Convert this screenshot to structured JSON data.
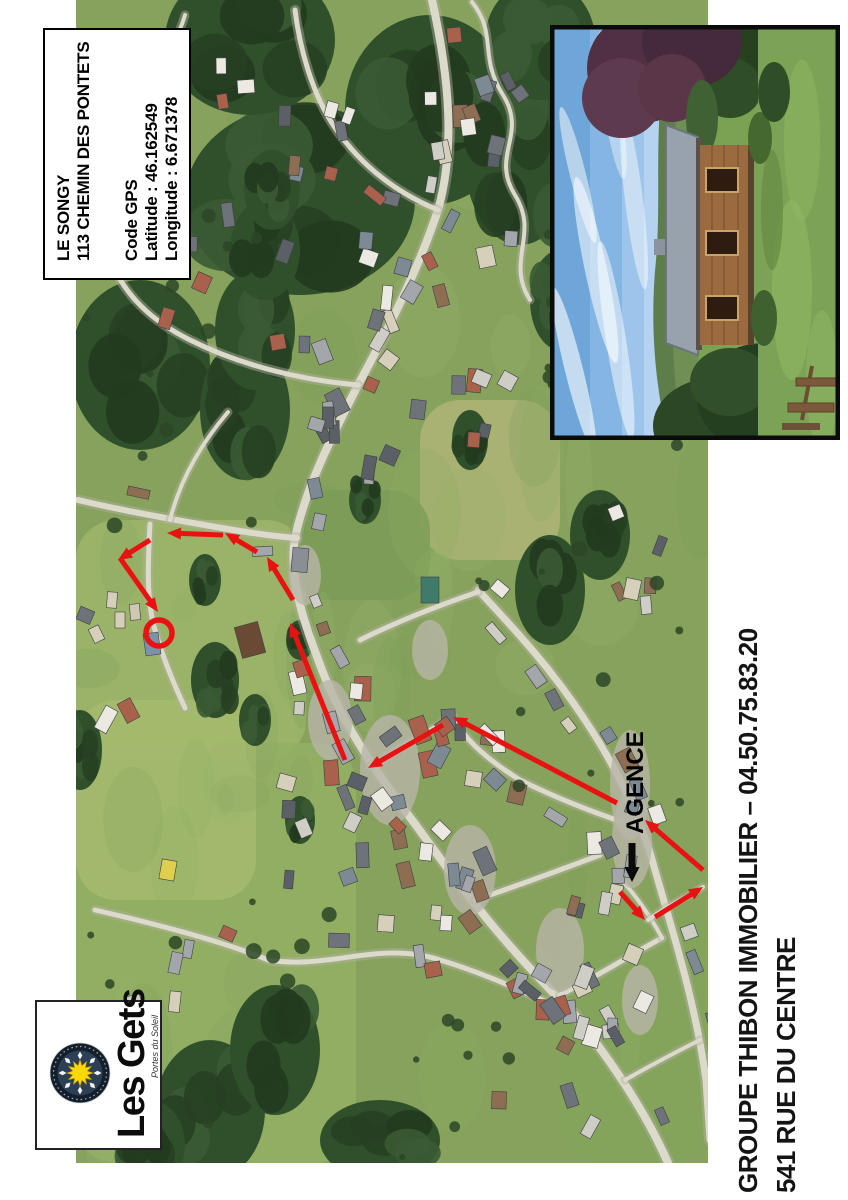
{
  "info_box": {
    "line1": "LE SONGY",
    "line2": "113 CHEMIN DES PONTETS",
    "line3": "Code GPS",
    "line4": "Latitude : 46.162549",
    "line5": "Longitude : 6.671378"
  },
  "footer": {
    "line1": "GROUPE THIBON IMMOBILIER – 04.50.75.83.20",
    "line2": "541 RUE DU CENTRE"
  },
  "logo": {
    "title": "Les Gets",
    "tagline": "Portes du Soleil"
  },
  "map": {
    "agence_label": "AGENCE",
    "route_color": "#e81212",
    "agence_arrow_color": "#0a0a0a",
    "route_segments": [
      [
        308,
        620,
        280,
        645
      ],
      [
        283,
        655,
        313,
        703
      ],
      [
        330,
        703,
        380,
        645
      ],
      [
        397,
        617,
        483,
        453
      ],
      [
        475,
        443,
        432,
        368
      ],
      [
        440,
        345,
        577,
        290
      ],
      [
        600,
        293,
        643,
        267
      ],
      [
        648,
        257,
        667,
        225
      ],
      [
        665,
        223,
        667,
        167
      ],
      [
        660,
        150,
        640,
        118
      ],
      [
        642,
        120,
        588,
        158
      ]
    ],
    "destination_circle": {
      "cx": 567,
      "cy": 159,
      "r": 13
    },
    "agence_arrow": [
      357,
      632,
      318,
      632
    ],
    "agence_label_pos": [
      366,
      643
    ]
  }
}
